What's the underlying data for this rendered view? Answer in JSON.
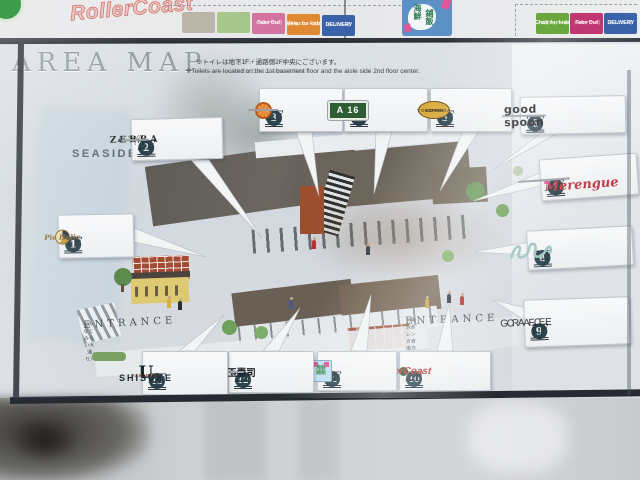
{
  "banner": {
    "brand": "RollerCoast",
    "tags_left": [
      {
        "jp": "",
        "en": ""
      },
      {
        "jp": "",
        "en": ""
      },
      {
        "jp": "テイクアウト可",
        "en": "Take Out"
      },
      {
        "jp": "お子様メニューあり",
        "en": "Menu for kids"
      },
      {
        "jp": "デリバリー可",
        "en": "DELIVERY"
      }
    ],
    "vertical_sign": {
      "col1": "海鮮",
      "col2": "鋪飯"
    },
    "tags_right": [
      {
        "jp": "キッズ用チェアーあり",
        "en": "Chair for kids"
      },
      {
        "jp": "テイクアウト可",
        "en": "Take Out"
      },
      {
        "jp": "デリバリー可",
        "en": "DELIVERY"
      }
    ]
  },
  "board": {
    "title": "AREA MAP",
    "note_jp_faded": "※――――は地下1Fにございます。",
    "note_jp": "※トイレは地下1F・通路側2F中央にございます。",
    "note_en_faded": "※――― ――― of the 1st basement floor.",
    "note_en": "※Toilets are located on the 1st basement floor and the aisle side 2nd floor center.",
    "seaside": "SEASIDE",
    "seaside_arrow": "▲",
    "entrance_left": {
      "label": "ENTRANCE",
      "sub": "（みなとみらい大通り）"
    },
    "entrance_right": {
      "label": "ENTRANCE",
      "sub": "（横浜赤レンガ倉庫方面）"
    },
    "markers": [
      {
        "num": "1",
        "floor": "1F",
        "store": "Pie Holic"
      },
      {
        "num": "2",
        "floor": "2F",
        "store": "ZEBRA"
      },
      {
        "num": "3",
        "floor": "2F",
        "store": ""
      },
      {
        "num": "4",
        "floor": "2F",
        "store": "A 16"
      },
      {
        "num": "5",
        "floor": "1F",
        "store": "COFFEE",
        "sub": "YOKOHAMA"
      },
      {
        "num": "6",
        "floor": "2F",
        "store": "good spoon"
      },
      {
        "num": "7",
        "floor": "2F",
        "store": "Merengue"
      },
      {
        "num": "8",
        "floor": "1F",
        "store": ""
      },
      {
        "num": "9",
        "floor": "1F",
        "line1": "CAFE",
        "line2": "GRACE"
      },
      {
        "num": "10",
        "floor": "2F",
        "store": "RollerCoast"
      },
      {
        "num": "11",
        "floor": "2F",
        "store": "海鮮鋪飯"
      },
      {
        "num": "12",
        "floor": "2F",
        "store": "築地玉壽司"
      },
      {
        "num": "13",
        "floor": "2F",
        "store": "SHISUKE",
        "sub": "YAKINIKU",
        "initial": "U"
      }
    ]
  },
  "colors": {
    "marker_circle": "#29464f",
    "tag_green": "#6aa83f",
    "tag_pink": "#c13570",
    "tag_orange": "#df8a33",
    "tag_blue": "#3a62a8",
    "merengue_red": "#c13a45",
    "rollercoast_red": "#bf3a31",
    "a16_green": "#2e5c33",
    "frame_dark": "#262b33"
  }
}
